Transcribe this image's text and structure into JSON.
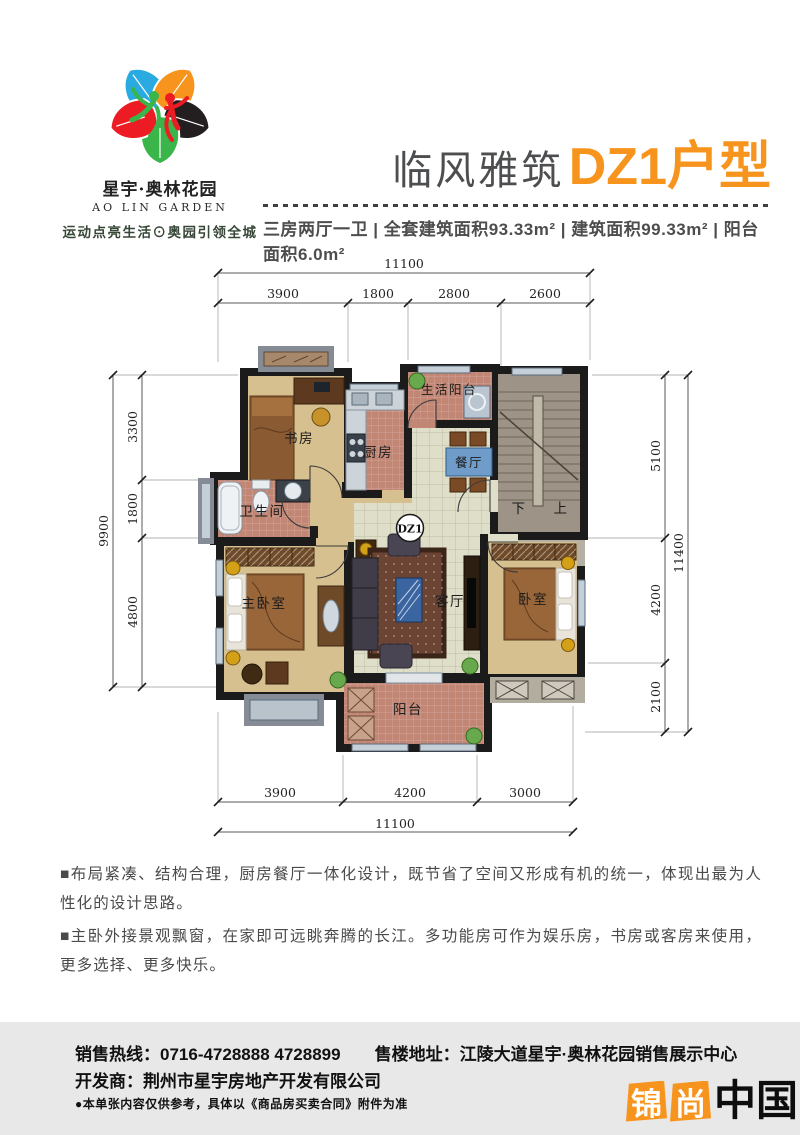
{
  "colors": {
    "accent_orange": "#F7941D",
    "title_gray": "#4D4E50",
    "footer_bg": "#E8E8E8",
    "wall_black": "#1B1B1B",
    "wood_floor": "#D7C08F",
    "tile_red": "#C28674",
    "tile_pale": "#DFDEC8"
  },
  "logo": {
    "name_cn": "星宇·奥林花园",
    "name_en": "AO LIN GARDEN",
    "tagline": "运动点亮生活⊙奥园引领全城"
  },
  "header": {
    "title_prefix": "临风雅筑",
    "title_main": "DZ1户型",
    "specs": "三房两厅一卫 | 全套建筑面积93.33m² | 建筑面积99.33m² | 阳台面积6.0m²"
  },
  "floor_plan": {
    "unit_label": "DZ1",
    "rooms": {
      "study": "书房",
      "kitchen": "厨房",
      "service_balcony": "生活阳台",
      "dining": "餐厅",
      "bathroom": "卫生间",
      "master_bedroom": "主卧室",
      "living_room": "客厅",
      "bedroom": "卧室",
      "balcony": "阳台",
      "stairs_down": "下",
      "stairs_up": "上"
    },
    "dimensions": {
      "top": {
        "total": "11100",
        "segments": [
          "3900",
          "1800",
          "2800",
          "2600"
        ]
      },
      "bottom": {
        "total": "11100",
        "segments": [
          "3900",
          "4200",
          "3000"
        ]
      },
      "left": {
        "total": "9900",
        "segments": [
          "3300",
          "1800",
          "4800"
        ]
      },
      "right": {
        "total": "11400",
        "segments": [
          "5100",
          "4200",
          "2100"
        ]
      }
    }
  },
  "description": {
    "para1": "■布局紧凑、结构合理，厨房餐厅一体化设计，既节省了空间又形成有机的统一，体现出最为人性化的设计思路。",
    "para2": "■主卧外接景观飘窗，在家即可远眺奔腾的长江。多功能房可作为娱乐房，书房或客房来使用，更多选择、更多快乐。"
  },
  "footer": {
    "hotline_label": "销售热线：",
    "hotline": "0716-4728888 4728899",
    "address_label": "售楼地址：",
    "address": "江陵大道星宇·奥林花园销售展示中心",
    "developer_label": "开发商：",
    "developer": "荆州市星宇房地产开发有限公司",
    "disclaimer": "●本单张内容仅供参考，具体以《商品房买卖合同》附件为准"
  },
  "watermark": {
    "box1": "锦",
    "box2": "尚",
    "suffix": "中国"
  }
}
